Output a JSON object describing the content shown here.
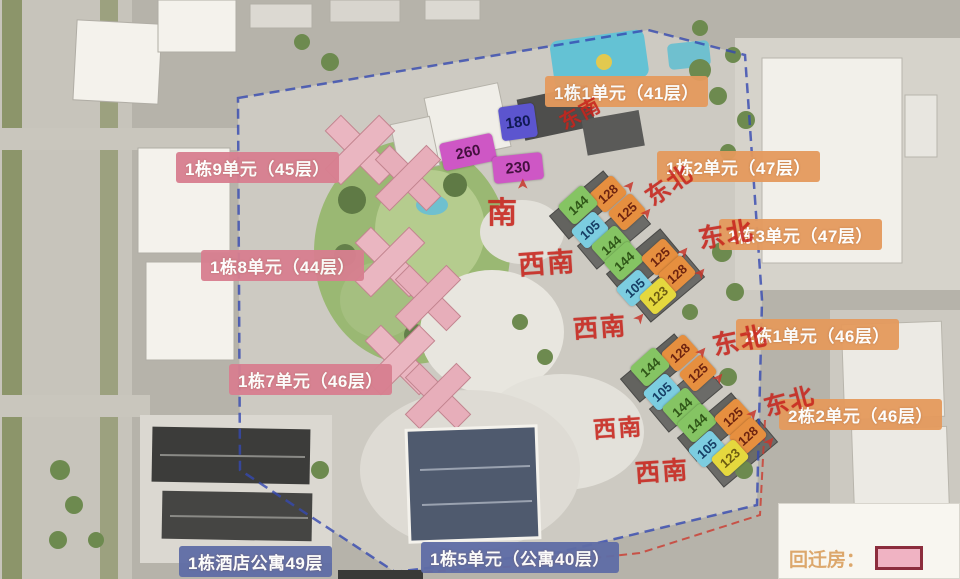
{
  "legend": {
    "title": "回迁房：",
    "swatch_color": "#f0b3c3",
    "swatch_border": "#8c2d3d"
  },
  "colors": {
    "label_bg": {
      "orange": "#e59a5d",
      "pink": "#d87f90",
      "blue": "#5f6da6"
    },
    "label_text": "#ffffff",
    "tag_bg": {
      "orange": "#e68f3f",
      "green": "#85c463",
      "lightblue": "#7ccde0",
      "yellow": "#e5d83e",
      "magenta": "#ce57c5",
      "indigo": "#5c55cf"
    },
    "tag_text": {
      "orange": "#6e2410",
      "green": "#2f5618",
      "lightblue": "#173f66",
      "yellow": "#6d5c12",
      "magenta": "#44103f",
      "indigo": "#101a55"
    },
    "direction": "#c8251d",
    "arrow": "#c8372c",
    "boundary_blue": "#3448b0",
    "boundary_red": "#cc3a2e"
  },
  "building_labels": [
    {
      "text": "1栋1单元（41层）",
      "type": "orange",
      "x": 545,
      "y": 76
    },
    {
      "text": "1栋2单元（47层）",
      "type": "orange",
      "x": 657,
      "y": 151
    },
    {
      "text": "1栋3单元（47层）",
      "type": "orange",
      "x": 719,
      "y": 219
    },
    {
      "text": "2栋1单元（46层）",
      "type": "orange",
      "x": 736,
      "y": 319
    },
    {
      "text": "2栋2单元（46层）",
      "type": "orange",
      "x": 779,
      "y": 399
    },
    {
      "text": "1栋9单元（45层）",
      "type": "pink",
      "x": 176,
      "y": 152
    },
    {
      "text": "1栋8单元（44层）",
      "type": "pink",
      "x": 201,
      "y": 250
    },
    {
      "text": "1栋7单元（46层）",
      "type": "pink",
      "x": 229,
      "y": 364
    },
    {
      "text": "1栋酒店公寓49层",
      "type": "blue",
      "x": 179,
      "y": 546
    },
    {
      "text": "1栋5单元（公寓40层）",
      "type": "blue",
      "x": 421,
      "y": 542
    }
  ],
  "unit_tags": [
    {
      "value": "180",
      "color": "indigo",
      "x": 518,
      "y": 122,
      "w": 36,
      "h": 34,
      "rot": -8,
      "fs": 15
    },
    {
      "value": "260",
      "color": "magenta",
      "x": 468,
      "y": 152,
      "w": 54,
      "h": 28,
      "rot": -12,
      "fs": 15
    },
    {
      "value": "230",
      "color": "magenta",
      "x": 518,
      "y": 168,
      "w": 50,
      "h": 27,
      "rot": -6,
      "fs": 15
    },
    {
      "value": "128",
      "color": "orange",
      "x": 608,
      "y": 194,
      "w": 31,
      "h": 25,
      "rot": -42,
      "fs": 13
    },
    {
      "value": "125",
      "color": "orange",
      "x": 627,
      "y": 212,
      "w": 31,
      "h": 25,
      "rot": -42,
      "fs": 13
    },
    {
      "value": "144",
      "color": "green",
      "x": 578,
      "y": 205,
      "w": 33,
      "h": 26,
      "rot": -42,
      "fs": 13
    },
    {
      "value": "105",
      "color": "lightblue",
      "x": 590,
      "y": 230,
      "w": 31,
      "h": 25,
      "rot": -42,
      "fs": 13
    },
    {
      "value": "144",
      "color": "green",
      "x": 611,
      "y": 245,
      "w": 33,
      "h": 26,
      "rot": -42,
      "fs": 13
    },
    {
      "value": "144",
      "color": "green",
      "x": 624,
      "y": 261,
      "w": 33,
      "h": 26,
      "rot": -42,
      "fs": 13
    },
    {
      "value": "125",
      "color": "orange",
      "x": 660,
      "y": 257,
      "w": 31,
      "h": 25,
      "rot": -42,
      "fs": 13
    },
    {
      "value": "128",
      "color": "orange",
      "x": 677,
      "y": 274,
      "w": 31,
      "h": 25,
      "rot": -42,
      "fs": 13
    },
    {
      "value": "105",
      "color": "lightblue",
      "x": 635,
      "y": 288,
      "w": 31,
      "h": 25,
      "rot": -42,
      "fs": 13
    },
    {
      "value": "123",
      "color": "yellow",
      "x": 658,
      "y": 296,
      "w": 31,
      "h": 25,
      "rot": -42,
      "fs": 13
    },
    {
      "value": "128",
      "color": "orange",
      "x": 680,
      "y": 353,
      "w": 31,
      "h": 25,
      "rot": -42,
      "fs": 13
    },
    {
      "value": "125",
      "color": "orange",
      "x": 698,
      "y": 373,
      "w": 31,
      "h": 25,
      "rot": -42,
      "fs": 13
    },
    {
      "value": "144",
      "color": "green",
      "x": 650,
      "y": 367,
      "w": 33,
      "h": 26,
      "rot": -42,
      "fs": 13
    },
    {
      "value": "105",
      "color": "lightblue",
      "x": 662,
      "y": 392,
      "w": 31,
      "h": 25,
      "rot": -42,
      "fs": 13
    },
    {
      "value": "144",
      "color": "green",
      "x": 682,
      "y": 407,
      "w": 33,
      "h": 26,
      "rot": -42,
      "fs": 13
    },
    {
      "value": "144",
      "color": "green",
      "x": 697,
      "y": 423,
      "w": 33,
      "h": 26,
      "rot": -42,
      "fs": 13
    },
    {
      "value": "125",
      "color": "orange",
      "x": 733,
      "y": 417,
      "w": 31,
      "h": 25,
      "rot": -42,
      "fs": 13
    },
    {
      "value": "128",
      "color": "orange",
      "x": 748,
      "y": 436,
      "w": 31,
      "h": 25,
      "rot": -42,
      "fs": 13
    },
    {
      "value": "105",
      "color": "lightblue",
      "x": 707,
      "y": 449,
      "w": 31,
      "h": 25,
      "rot": -42,
      "fs": 13
    },
    {
      "value": "123",
      "color": "yellow",
      "x": 730,
      "y": 458,
      "w": 31,
      "h": 25,
      "rot": -42,
      "fs": 13
    }
  ],
  "direction_labels": [
    {
      "text": "东南",
      "x": 580,
      "y": 112,
      "rot": -28,
      "size": 20
    },
    {
      "text": "南",
      "x": 503,
      "y": 210,
      "rot": 0,
      "size": 30
    },
    {
      "text": "西南",
      "x": 547,
      "y": 261,
      "rot": -4,
      "size": 27
    },
    {
      "text": "西南",
      "x": 600,
      "y": 326,
      "rot": -4,
      "size": 25
    },
    {
      "text": "西南",
      "x": 618,
      "y": 426,
      "rot": -4,
      "size": 23
    },
    {
      "text": "西南",
      "x": 662,
      "y": 470,
      "rot": -4,
      "size": 25
    },
    {
      "text": "东北",
      "x": 668,
      "y": 183,
      "rot": -35,
      "size": 24
    },
    {
      "text": "东北",
      "x": 726,
      "y": 233,
      "rot": -10,
      "size": 26
    },
    {
      "text": "东北",
      "x": 740,
      "y": 339,
      "rot": -12,
      "size": 26
    },
    {
      "text": "东北",
      "x": 789,
      "y": 399,
      "rot": -15,
      "size": 24
    }
  ],
  "arrows": [
    {
      "x": 523,
      "y": 184,
      "rot": -90
    },
    {
      "x": 630,
      "y": 186,
      "rot": -50
    },
    {
      "x": 647,
      "y": 213,
      "rot": -50
    },
    {
      "x": 684,
      "y": 252,
      "rot": -50
    },
    {
      "x": 701,
      "y": 273,
      "rot": -50
    },
    {
      "x": 640,
      "y": 318,
      "rot": -50
    },
    {
      "x": 702,
      "y": 352,
      "rot": -50
    },
    {
      "x": 719,
      "y": 378,
      "rot": -50
    },
    {
      "x": 753,
      "y": 414,
      "rot": -50
    },
    {
      "x": 770,
      "y": 442,
      "rot": -50
    }
  ]
}
